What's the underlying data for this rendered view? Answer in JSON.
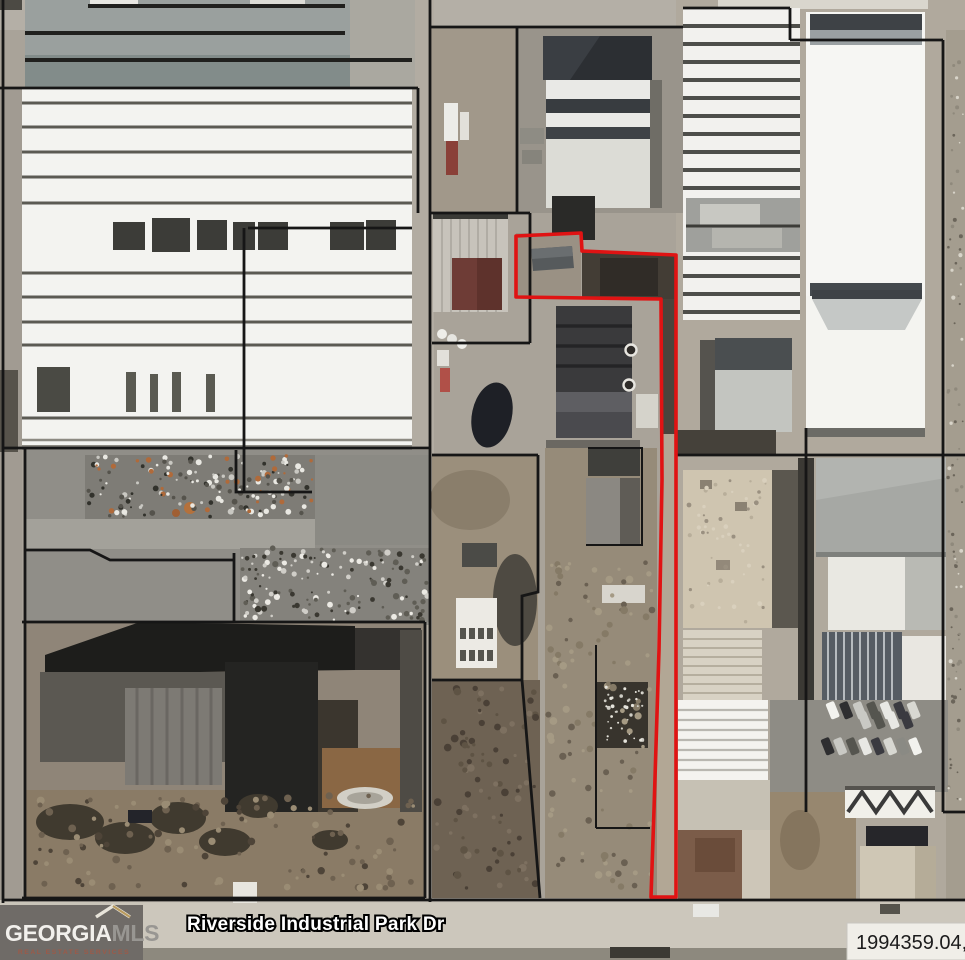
{
  "map": {
    "street_label": "Riverside Industrial Park Dr",
    "parcel_id_label": "1994359.04,",
    "highlight_outline_color": "#e01313",
    "parcel_line_color": "#161616"
  },
  "logo": {
    "name_part1": "GEORGIA",
    "name_part2": "MLS",
    "tagline": "REAL ESTATE SERVICES"
  }
}
